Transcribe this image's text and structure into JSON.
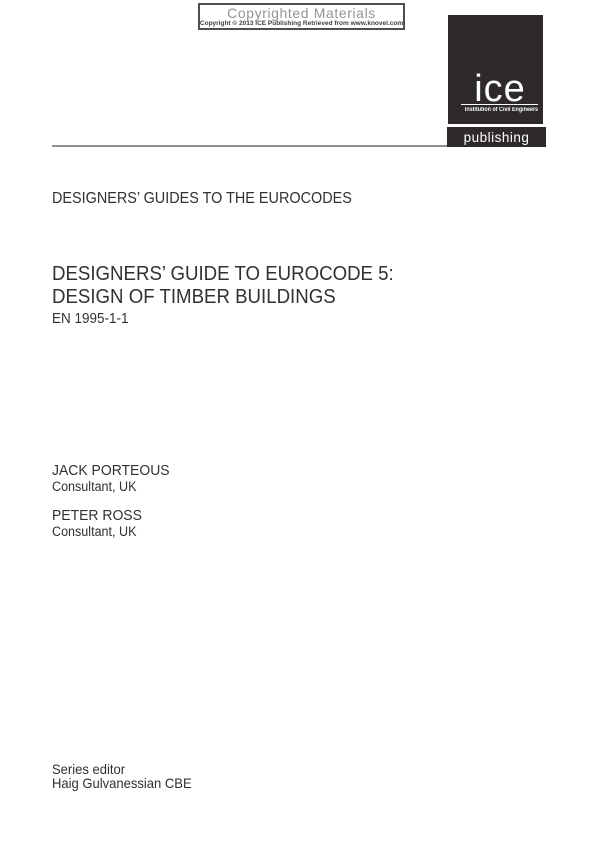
{
  "copyright_box": {
    "title": "Copyrighted Materials",
    "subtitle": "Copyright © 2013 ICE Publishing Retrieved from www.knovel.com"
  },
  "logo": {
    "brand": "ice",
    "institution": "Institution of Civil Engineers",
    "division": "publishing",
    "brand_bg_color": "#2e2a2b",
    "brand_text_color": "#ffffff"
  },
  "series_heading": "DESIGNERS’ GUIDES TO THE EUROCODES",
  "title": {
    "line1": "DESIGNERS’ GUIDE TO EUROCODE 5:",
    "line2": "DESIGN OF TIMBER BUILDINGS",
    "code": "EN 1995-1-1"
  },
  "authors": [
    {
      "name": "JACK PORTEOUS",
      "role": "Consultant, UK"
    },
    {
      "name": "PETER ROSS",
      "role": "Consultant, UK"
    }
  ],
  "series_editor": {
    "label": "Series editor",
    "name": "Haig Gulvanessian CBE"
  }
}
